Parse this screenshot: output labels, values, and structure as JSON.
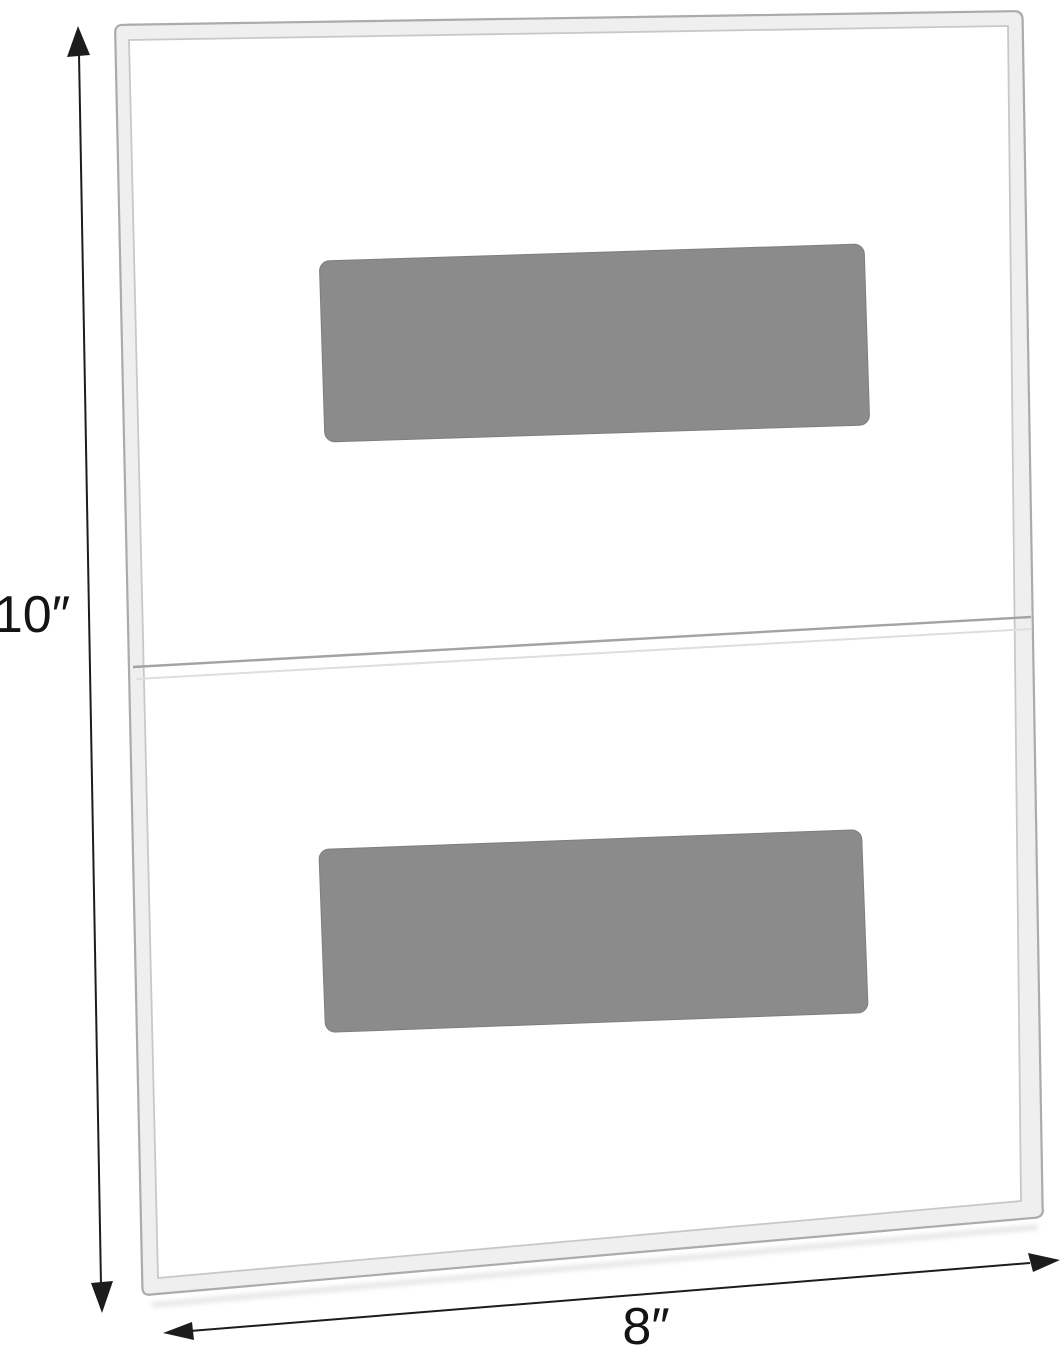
{
  "diagram": {
    "dimensions": {
      "height": "10″",
      "width": "8″"
    },
    "colors": {
      "pad_gray": "#8b8b8b",
      "frame_band": "#efefef",
      "frame_outline": "#ababab",
      "frame_inner_outline": "#c8c8c8",
      "divider": "#a3a3a3",
      "dimension_ink": "#1c1c1c",
      "background": "#ffffff"
    }
  }
}
